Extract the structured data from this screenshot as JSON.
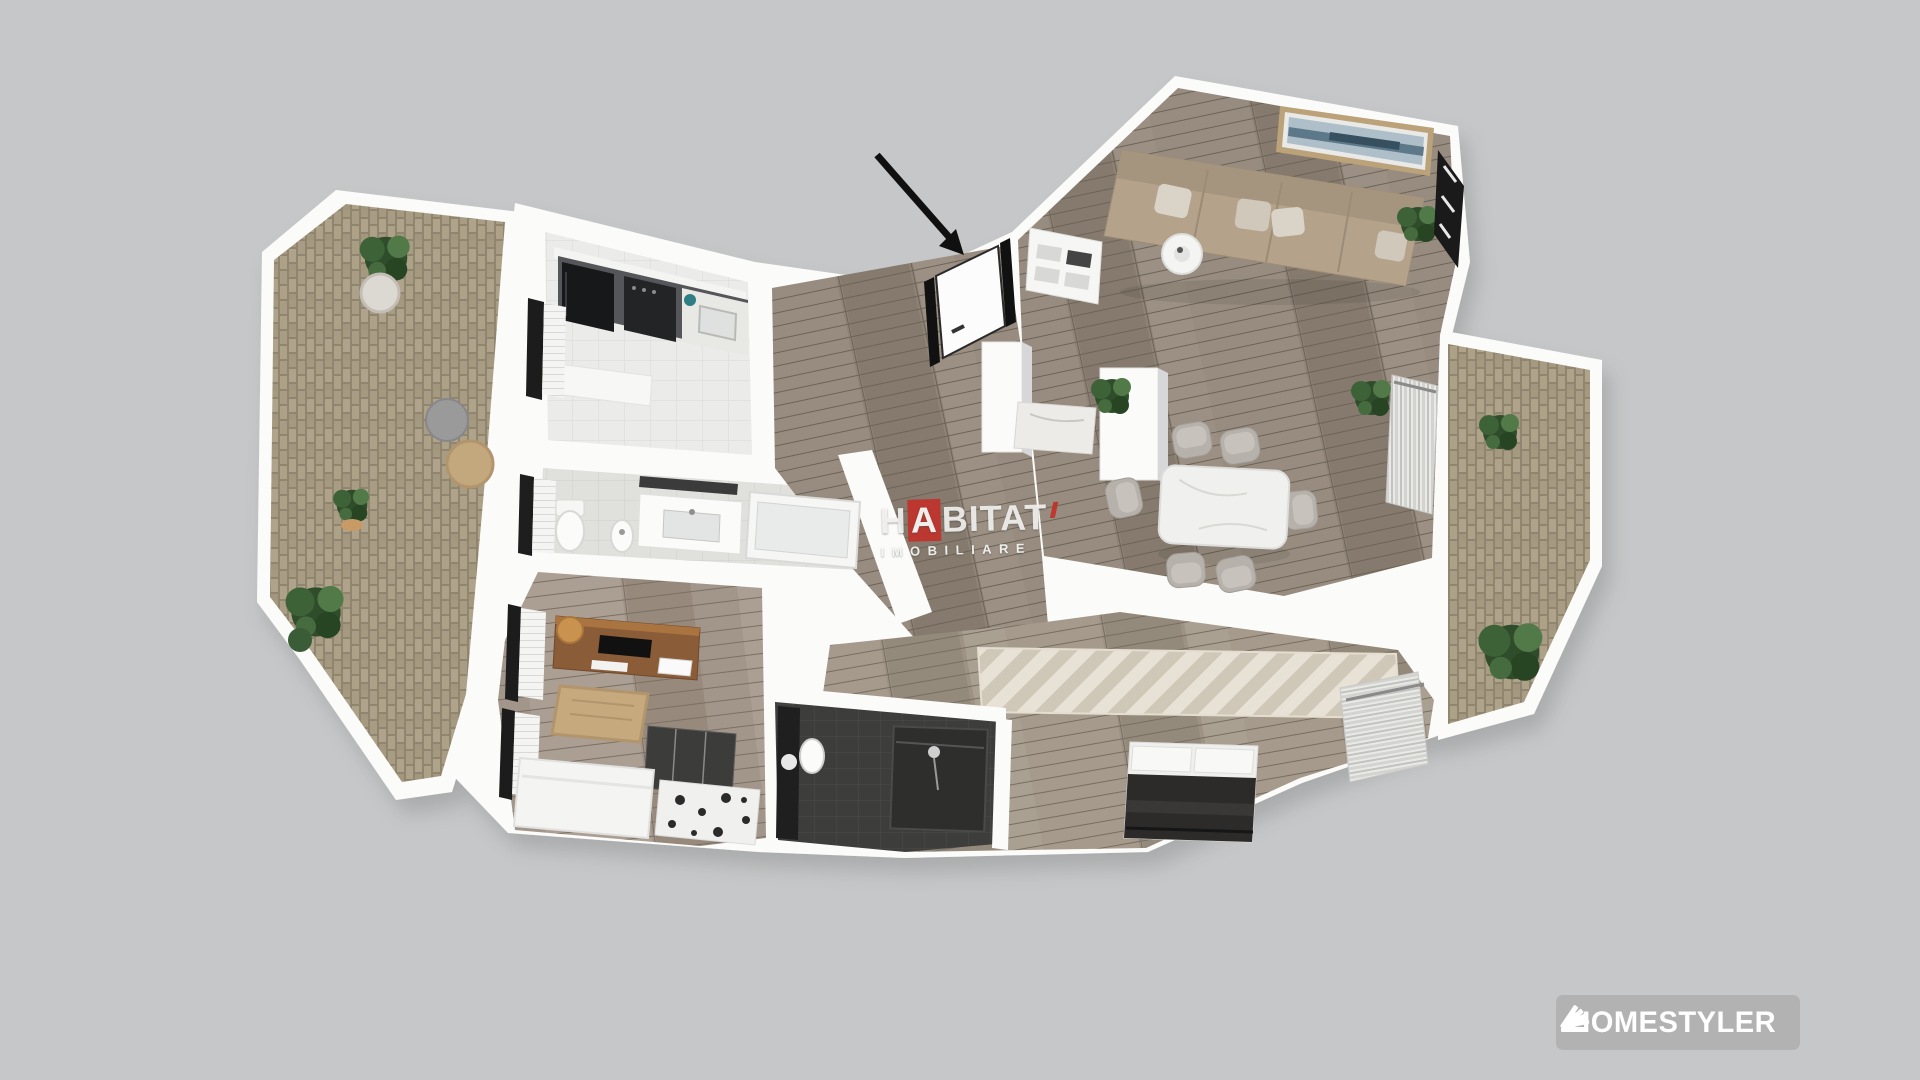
{
  "scene": {
    "background_color": "#c6c7c8",
    "description": "3D rendered top-down floor plan of a two-bedroom apartment with two balconies"
  },
  "watermark": {
    "part1": "H",
    "accent_letter": "A",
    "part2": "BITAT",
    "line2": "IMOBILIARE",
    "accent_color": "#bf342c",
    "text_color": "#f4f3f1"
  },
  "brand_badge": {
    "label": "HOMESTYLER",
    "icon": "swatch-fan-icon",
    "background_color": "#b1b1b1",
    "text_color": "#ffffff"
  },
  "annotation_arrow": {
    "color": "#101010",
    "points_to": "entrance-door"
  },
  "palette": {
    "wall": "#fbfbfa",
    "wood_floor": "#8f8377",
    "wood_floor_light": "#9d9284",
    "kitchen_tile": "#ebebe9",
    "bath_tile": "#e0e0dd",
    "brick_paver": "#a89c85",
    "dark_bath_tile": "#3d3d3c",
    "sofa": "#b4a28b",
    "dining_chair": "#b6b1ab",
    "marble": "#efefed",
    "bed_dark": "#2c2b2a",
    "desk_wood": "#8a5c38",
    "plant_green": "#3d5c38",
    "painting_blue": "#7e96a6"
  }
}
